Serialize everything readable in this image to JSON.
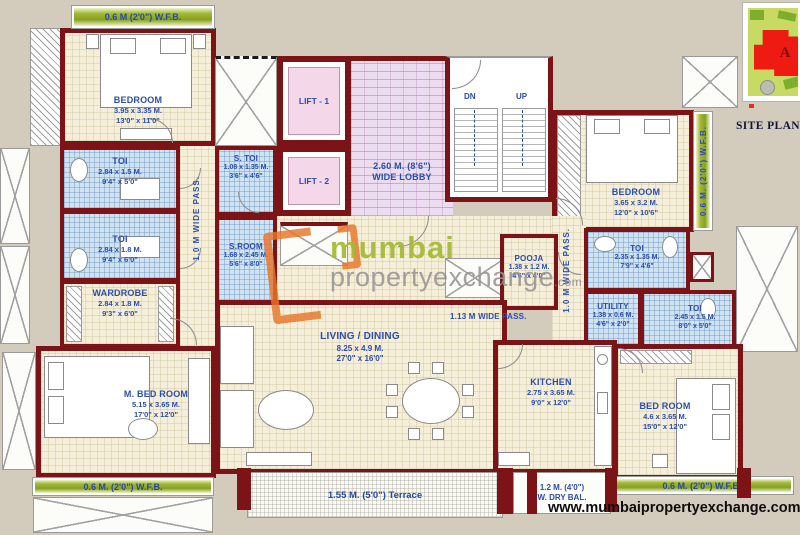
{
  "rooms": {
    "bedroom_tl": {
      "name": "BEDROOM",
      "m": "3.95 x 3.35 M.",
      "ft": "13'0\" x 11'0\""
    },
    "toi1": {
      "name": "TOI",
      "m": "2.84 x 1.5 M.",
      "ft": "9'4\" x 5'0\""
    },
    "toi2": {
      "name": "TOI",
      "m": "2.84 x 1.8 M.",
      "ft": "9'4\" x 6'0\""
    },
    "wardrobe": {
      "name": "WARDROBE",
      "m": "2.84 x 1.8 M.",
      "ft": "9'3\" x 6'0\""
    },
    "mbed": {
      "name": "M. BED ROOM",
      "m": "5.15 x 3.65 M.",
      "ft": "17'0\" x 12'0\""
    },
    "stoi": {
      "name": "S. TOI",
      "m": "1.08 x 1.35 M.",
      "ft": "3'6\" x 4'6\""
    },
    "sroom": {
      "name": "S.ROOM",
      "m": "1.68 x 2.45 M.",
      "ft": "5'6\" x 8'0\""
    },
    "living": {
      "name": "LIVING / DINING",
      "m": "8.25 x 4.9 M.",
      "ft": "27'0\" x 16'0\""
    },
    "pooja": {
      "name": "POOJA",
      "m": "1.38 x 1.2 M.",
      "ft": "4'6\" x 4'0\""
    },
    "toi_r1": {
      "name": "TOI",
      "m": "2.35 x 1.35 M.",
      "ft": "7'9\" x 4'6\""
    },
    "utility": {
      "name": "UTILITY",
      "m": "1.38 x 0.6 M.",
      "ft": "4'6\" x 2'0\""
    },
    "toi_r2": {
      "name": "TOI",
      "m": "2.45 x 1.5 M.",
      "ft": "8'0\" x 5'0\""
    },
    "bedroom_tr": {
      "name": "BEDROOM",
      "m": "3.65 x 3.2 M.",
      "ft": "12'0\" x 10'6\""
    },
    "kitchen": {
      "name": "KITCHEN",
      "m": "2.75 x 3.65 M.",
      "ft": "9'0\" x 12'0\""
    },
    "bedroom_br": {
      "name": "BED ROOM",
      "m": "4.6 x 3.65 M.",
      "ft": "15'0\" x 12'0\""
    }
  },
  "lifts": {
    "lift1": "LIFT - 1",
    "lift2": "LIFT - 2"
  },
  "lobby": {
    "m": "2.60 M. (8'6\")",
    "name": "WIDE LOBBY"
  },
  "stairs": {
    "dn": "DN",
    "up": "UP"
  },
  "bands": {
    "wfb_top": "0.6 M (2'0\") W.F.B.",
    "wfb_bottom_left": "0.6 M. (2'0\") W.F.B.",
    "wfb_right": "0.6 M. (2'0\") W.F.B.",
    "wfb_bottom_right": "0.6 M. (2'0\") W.F.B.",
    "terrace": "1.55 M. (5'0\") Terrace",
    "drybal_m": "1.2 M. (4'0\")",
    "drybal_name": "W. DRY BAL."
  },
  "passes": {
    "left": "1.0 M WIDE PASS.",
    "right": "1.0 M WIDE PASS.",
    "horizontal": "1.13 M WIDE PASS."
  },
  "watermark": {
    "brand": "mumbai",
    "brand2": "propertyexchange",
    "suffix": ".com"
  },
  "footer": {
    "website": "www.mumbaipropertyexchange.com"
  },
  "siteplan": {
    "label": "SITE PLAN",
    "building": "A"
  },
  "colors": {
    "wall": "#7c1417",
    "label_blue": "#2b4db0",
    "band_green": "#87a021",
    "watermark_orange": "#e8762a",
    "siteplan_red": "#ee1b12"
  }
}
